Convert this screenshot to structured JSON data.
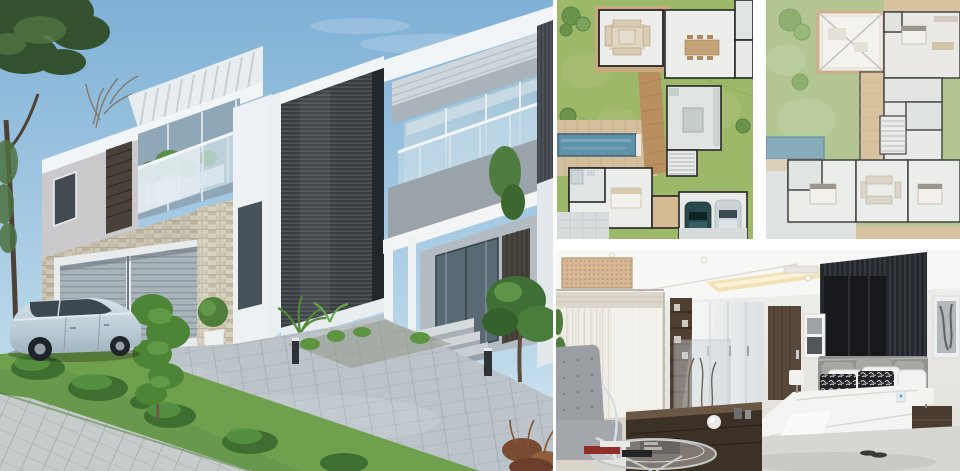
{
  "collage": {
    "layout": {
      "width": 960,
      "height": 471
    },
    "panels": {
      "exterior": {
        "label": "Modern two-storey villa exterior render"
      },
      "plan_ground": {
        "label": "Ground floor plan with pool and double garage"
      },
      "plan_first": {
        "label": "First floor plan with bedrooms and void"
      },
      "bedroom": {
        "label": "Master bedroom interior render"
      }
    }
  },
  "colors": {
    "gap_color": "#ffffff",
    "sky_top": "#7fb0d6",
    "sky_low": "#d9e9f2",
    "foliage_dark": "#33512e",
    "foliage_mid": "#4d7240",
    "foliage_light": "#6f9b52",
    "white_wall": "#f2f5f7",
    "stucco": "#cbc9cb",
    "grey_band": "#9aa3a9",
    "louver_dark": "#383d40",
    "louver_line": "#5a6166",
    "louver_brown": "#4a423a",
    "stone_base": "#d7d1c0",
    "stone_dark": "#b3ab94",
    "garage_door": "#a9b3ba",
    "garage_rib": "#8d98a1",
    "glass_dark": "#8fa7b7",
    "glass_light": "#a9c6d9",
    "railing": "#c7dce9",
    "door_glass": "#5a6a74",
    "slat_panel": "#4a443e",
    "drive": "#bcc4ca",
    "drive_line": "#a3acb3",
    "sidewalk": "#c6cccb",
    "grass": "#6fa04e",
    "grass_dark": "#4f7d3a",
    "car_body": "#c9d6de",
    "car_window": "#3d474f",
    "plan1_lawn": "#9eb86a",
    "plan2_lawn": "#aabf87",
    "plan_tree": "#6a944c",
    "plan_tree_dark": "#55803c",
    "pool1": "#5f91a9",
    "pool2": "#7ca3b5",
    "pool_edge": "#3d6577",
    "deck": "#d3bf9e",
    "walkway_wood": "#b98f60",
    "plan_wall": "#262626",
    "plan_floor": "#eceeec",
    "plan_floor2": "#e0e4e3",
    "plan_tan": "#d5bb93",
    "plan_pave": "#d8dbdc",
    "plan_car_teal": "#27494b",
    "plan_car_grey": "#ccd2d6",
    "bed_ceiling": "#f7f7f5",
    "cove_light": "#f2dfae",
    "bslat": "#24272b",
    "bslat_line": "#40454c",
    "blind_dark": "#17191c",
    "panel_beige": "#d8b795",
    "panel_dot": "#bd9871",
    "curtain": "#efece6",
    "blind_hdr": "#dcd6cb",
    "wood_dark": "#4e3f32",
    "wardrobe": "#eef0f2",
    "door_wood": "#57483a",
    "headboard": "#90938f",
    "pillow_grey": "#a5a7a3",
    "pillow_white": "#f2f2f0",
    "pillow_black": "#212326",
    "duvet": "#f4f4f2",
    "base_woven": "#c9bda9",
    "base_grey": "#6f716e",
    "nightstand": "#4a3c30",
    "rug": "#d6d7d3",
    "floor_warm": "#d9d4ca",
    "chair_grey": "#9a9da1",
    "chrome": "#d9dde0",
    "book_red": "#8e3029",
    "book_dark": "#232527"
  }
}
